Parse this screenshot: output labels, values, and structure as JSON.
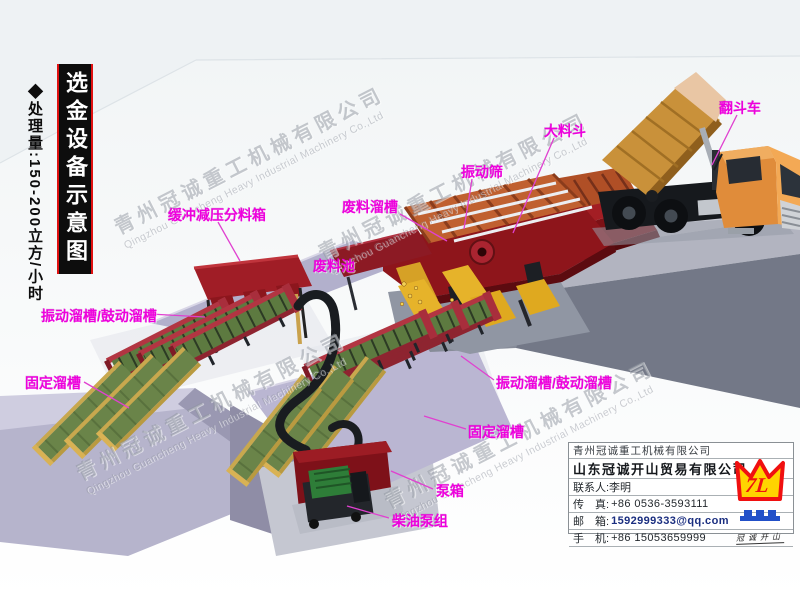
{
  "side_banner": {
    "title": "选金设备示意图",
    "capacity": "◆处理量:150-200立方/小时"
  },
  "watermarks": {
    "cn": "青州冠诚重工机械有限公司",
    "en": "Qingzhou Guancheng Heavy Industrial Machinery Co.,Ltd",
    "positions": [
      [
        118,
        212
      ],
      [
        322,
        238
      ],
      [
        80,
        458
      ],
      [
        388,
        486
      ]
    ]
  },
  "equipment_labels": [
    {
      "id": "buffer-splitter-box",
      "text": "缓冲减压分料箱",
      "x": 168,
      "y": 205,
      "leader": [
        218,
        222,
        240,
        261
      ]
    },
    {
      "id": "waste-chute",
      "text": "废料溜槽",
      "x": 342,
      "y": 197,
      "leader": [
        400,
        214,
        447,
        241
      ]
    },
    {
      "id": "vibrating-screen",
      "text": "振动筛",
      "x": 461,
      "y": 162,
      "leader": [
        472,
        179,
        464,
        229
      ]
    },
    {
      "id": "big-hopper",
      "text": "大料斗",
      "x": 544,
      "y": 121,
      "leader": [
        554,
        138,
        513,
        233
      ]
    },
    {
      "id": "dump-truck",
      "text": "翻斗车",
      "x": 719,
      "y": 98,
      "leader": [
        737,
        115,
        712,
        165
      ]
    },
    {
      "id": "vibrating-sluice-left",
      "text": "振动溜槽/鼓动溜槽",
      "x": 41,
      "y": 306,
      "leader": [
        150,
        314,
        205,
        317
      ]
    },
    {
      "id": "fixed-sluice-left",
      "text": "固定溜槽",
      "x": 25,
      "y": 373,
      "leader": [
        84,
        382,
        129,
        408
      ]
    },
    {
      "id": "waste-pool",
      "text": "废料池",
      "x": 313,
      "y": 256,
      "leader": null
    },
    {
      "id": "vibrating-sluice-right",
      "text": "振动溜槽/鼓动溜槽",
      "x": 496,
      "y": 373,
      "leader": [
        494,
        380,
        461,
        356
      ]
    },
    {
      "id": "fixed-sluice-right",
      "text": "固定溜槽",
      "x": 468,
      "y": 422,
      "leader": [
        466,
        429,
        424,
        416
      ]
    },
    {
      "id": "pump-box",
      "text": "泵箱",
      "x": 436,
      "y": 481,
      "leader": [
        433,
        489,
        391,
        471
      ]
    },
    {
      "id": "diesel-pump-set",
      "text": "柴油泵组",
      "x": 392,
      "y": 511,
      "leader": [
        389,
        518,
        347,
        506
      ]
    }
  ],
  "contact_card": {
    "company_primary": "青州冠诚重工机械有限公司",
    "company_secondary": "山东冠诚开山贸易有限公司",
    "contact_person": "联系人:李明",
    "fax_label": "传　真:",
    "fax_value": "+86 0536-3593111",
    "email_label": "邮　箱:",
    "email_value": "1592999333@qq.com",
    "mobile_label": "手　机:",
    "mobile_value": "+86 15053659999"
  },
  "logo": {
    "monogram": "7L",
    "caption": "冠诚开山"
  },
  "colors": {
    "label_magenta": "#ee00dd",
    "banner_bg": "#0d0d0d",
    "banner_red": "#e01010",
    "equipment_red": "#8e151b",
    "hopper_red": "#9e1c22",
    "deck_orange": "#c06030",
    "chute_yellow": "#e6b32a",
    "sluice_green": "#5d7a40",
    "truck_orange": "#e08c3a",
    "bed_tan": "#c9913a",
    "trench_lavender": "#b5b3cb",
    "embankment_gray": "#737887",
    "platform_gray": "#b2b4c0",
    "logo_yellow": "#ffd400",
    "logo_red": "#f01010",
    "logo_blue": "#2250c8",
    "email_blue": "#1a2e80"
  }
}
